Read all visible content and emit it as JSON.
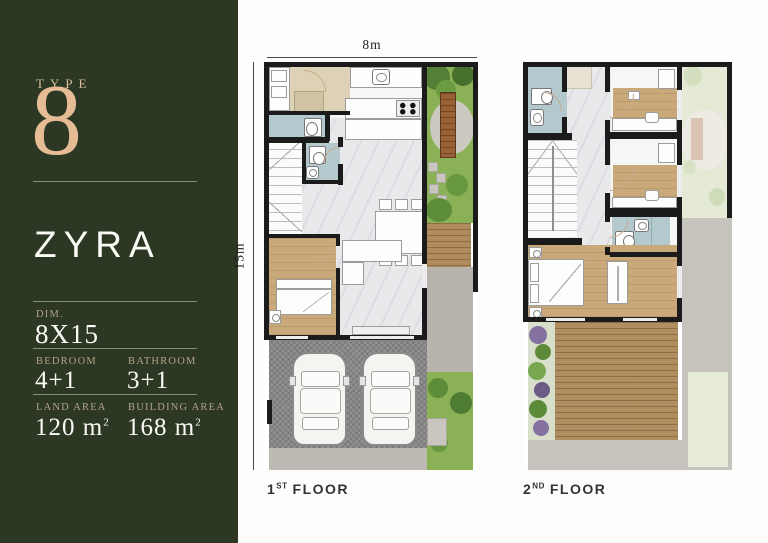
{
  "panel": {
    "type_label": "TYPE",
    "type_number": "8",
    "name": "ZYRA",
    "dim": {
      "label": "DIM.",
      "value": "8X15"
    },
    "bedroom": {
      "label": "BEDROOM",
      "value": "4+1"
    },
    "bathroom": {
      "label": "BATHROOM",
      "value": "3+1"
    },
    "land_area": {
      "label": "LAND AREA",
      "value": "120 m",
      "sup": "2"
    },
    "building_area": {
      "label": "BUILDING AREA",
      "value": "168 m",
      "sup": "2"
    },
    "colors": {
      "background": "#2c3823",
      "accent": "#e6bc95",
      "text": "#ffffff"
    }
  },
  "plans": {
    "first": {
      "width_dim": "8m",
      "height_dim": "15m",
      "label": {
        "num": "1",
        "ordinal": "ST",
        "word": "FLOOR"
      }
    },
    "second": {
      "label": {
        "num": "2",
        "ordinal": "ND",
        "word": "FLOOR"
      }
    }
  }
}
